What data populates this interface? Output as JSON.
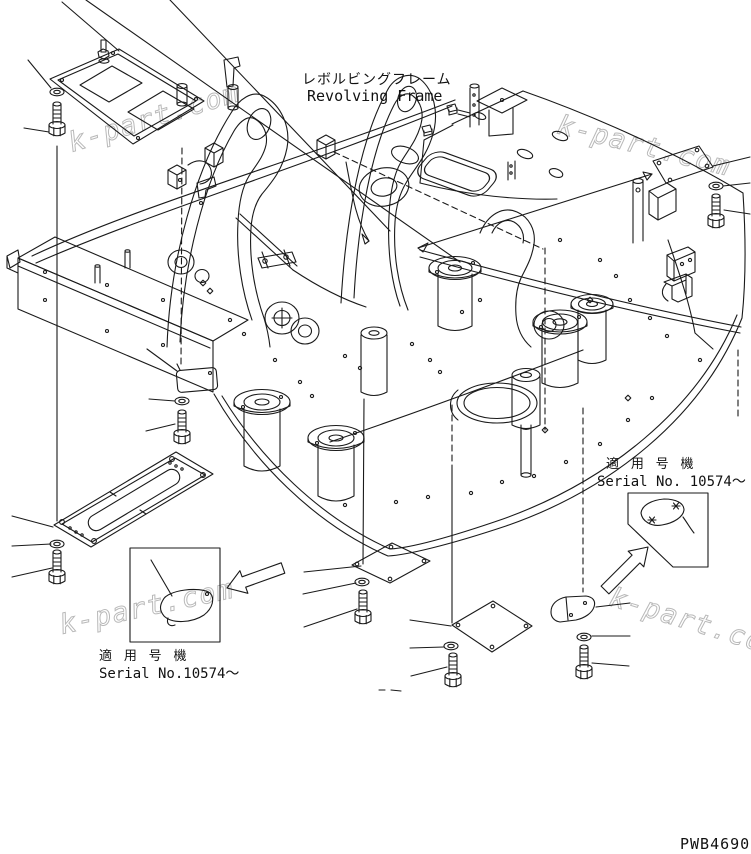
{
  "page": {
    "background": "#ffffff",
    "line_color": "#1a1a1a",
    "watermark_color": "#b9b9b9"
  },
  "title": {
    "jp": "レボルビングフレーム",
    "en": "Revolving Frame"
  },
  "annotations": {
    "serial_right": {
      "jp": "適 用 号 機",
      "en": "Serial No. 10574～"
    },
    "serial_left": {
      "jp": "適 用 号 機",
      "en": "Serial No.10574～"
    }
  },
  "drawing_number": "PWB4690",
  "watermark": {
    "text": "k-part.com"
  }
}
